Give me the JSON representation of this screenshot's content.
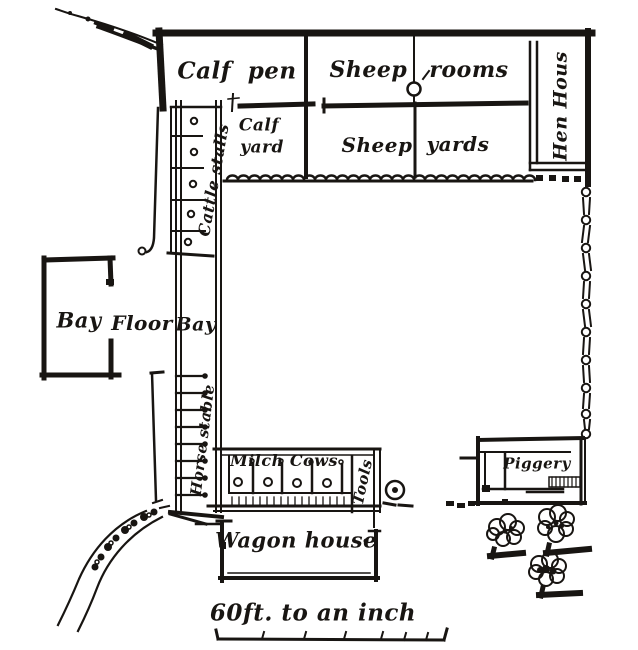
{
  "figure": {
    "kind": "engraved farm barnyard plan",
    "ink_color": "#181512",
    "paper_color": "#ffffff"
  },
  "labels": {
    "calf_pen": "Calf pen",
    "sheep_rooms": "Sheep rooms",
    "calf_yard_line1": "Calf",
    "calf_yard_line2": "yard",
    "sheep_yards_word1": "Sheep",
    "sheep_yards_word2": "yards",
    "hen_house": "Hen Hous",
    "cattle_stalls": "Cattle stalls",
    "bay_outer": "Bay",
    "floor": "Floor",
    "bay_barn": "Bay",
    "horse_stable": "Horse stable",
    "milch_cows": "Milch Cows",
    "tools": "Tools",
    "wagon_house": "Wagon house",
    "piggery": "Piggery",
    "scale_caption": "60ft. to an inch"
  },
  "features": {
    "cattle_stall_rings": 5,
    "horse_stalls": 8,
    "cow_stall_rings": 4,
    "cow_stall_posts": 4,
    "trees": 3,
    "well_icon": "circle-with-center-dot",
    "pump_icon": "circle-on-sheep-room-wall",
    "east_boundary": "chain-post-fence",
    "yard_south_edge": "scalloped-wall",
    "northeast_fence": "dotted-squares"
  }
}
